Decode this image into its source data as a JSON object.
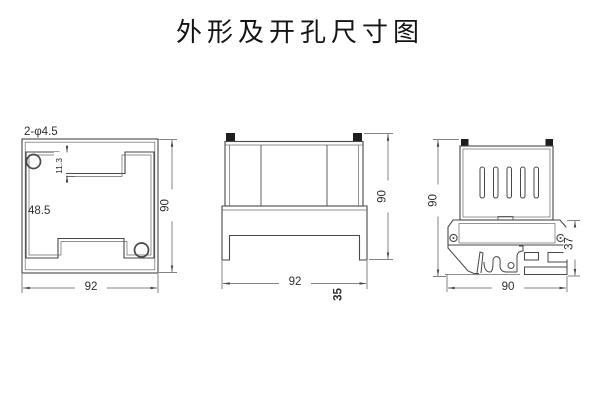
{
  "title": "外形及开孔尺寸图",
  "colors": {
    "line": "#474747",
    "thin_line": "#6a6a6a",
    "dim_line": "#5a5a5a",
    "text": "#2e2e2e",
    "ear_fill": "#1e1e1e",
    "background": "#ffffff"
  },
  "views": {
    "cutout": {
      "holes_label": "2-φ4.5",
      "inner_width_dim": "48.5",
      "step_dim": "11.3",
      "height_dim": "90",
      "width_dim": "92"
    },
    "front": {
      "width_dim": "92",
      "height_dim": "90",
      "depth_dim": "35"
    },
    "side": {
      "height_dim": "90",
      "rail_height_dim": "37",
      "width_dim": "90"
    }
  }
}
